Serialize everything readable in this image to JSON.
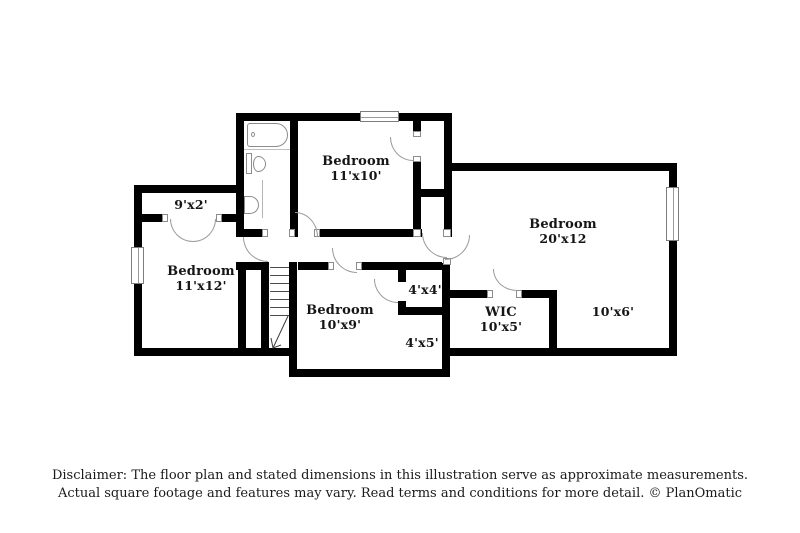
{
  "labels": {
    "bed_11x10": {
      "name": "Bedroom",
      "dims": "11'x10'"
    },
    "closet_9x2": {
      "dims": "9'x2'"
    },
    "bed_11x12": {
      "name": "Bedroom",
      "dims": "11'x12'"
    },
    "bed_20x12": {
      "name": "Bedroom",
      "dims": "20'x12"
    },
    "bed_10x9": {
      "name": "Bedroom",
      "dims": "10'x9'"
    },
    "closet_4x4": {
      "dims": "4'x4'"
    },
    "nook_4x5": {
      "dims": "4'x5'"
    },
    "wic": {
      "name": "WIC",
      "dims": "10'x5'"
    },
    "area_10x6": {
      "dims": "10'x6'"
    }
  },
  "disclaimer": {
    "line1": "Disclaimer: The floor plan and stated dimensions in this illustration serve as approximate measurements.",
    "line2": "Actual square footage and features may vary. Read terms and conditions for more detail. © PlanOmatic"
  },
  "colors": {
    "wall": "#000000",
    "door_line": "#9b9b9b",
    "fixture_line": "#8c8c8c",
    "text": "#151515"
  }
}
